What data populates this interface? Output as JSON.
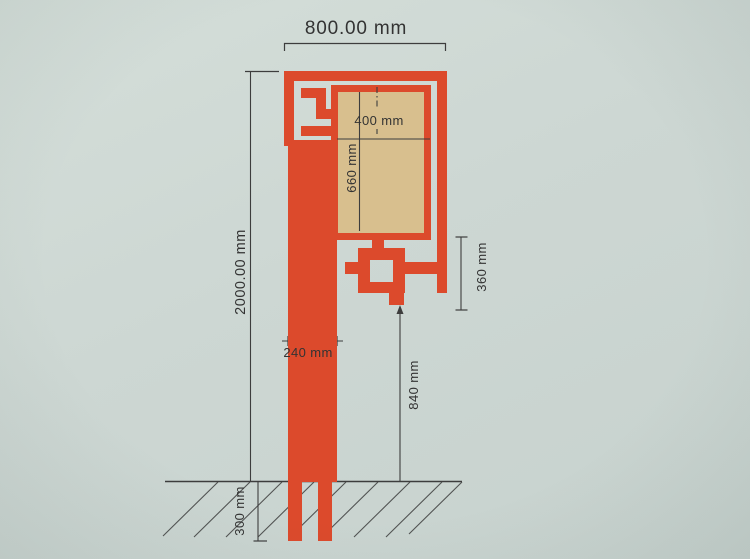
{
  "diagram": {
    "labels": {
      "overall_width": "800.00 mm",
      "overall_height": "2000.00 mm",
      "panel_width": "400 mm",
      "panel_height": "660 mm",
      "ornament_height": "360 mm",
      "post_width": "240 mm",
      "ground_clearance": "840 mm",
      "embed_depth": "300 mm"
    },
    "colors": {
      "background": "#cdd7d3",
      "structure_red": "#dc4a2c",
      "panel_tan": "#d8bf8e",
      "line": "#3d3d3d",
      "text": "#333333"
    }
  }
}
